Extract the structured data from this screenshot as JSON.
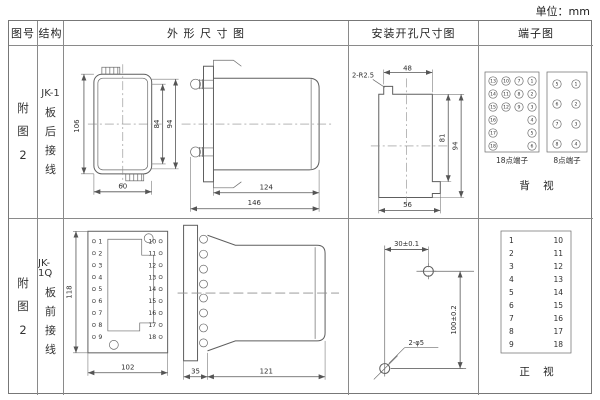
{
  "page": {
    "unit": "单位：mm"
  },
  "header": {
    "fig_no": "图号",
    "structure": "结构",
    "outline": "外 形 尺 寸 图",
    "mounting": "安装开孔尺寸图",
    "terminal": "端子图"
  },
  "row1": {
    "fig_no": [
      "附",
      "图",
      "2"
    ],
    "structure": [
      "JK-1",
      "板",
      "后",
      "接",
      "线"
    ],
    "outline": {
      "front_h": "106",
      "front_inner_h": "84",
      "front_outer_h": "94",
      "front_w": "60",
      "side_body": "124",
      "side_total": "146"
    },
    "mounting": {
      "corner_note": "2-R2.5",
      "top_w": "48",
      "inner_h": "81",
      "full_h": "94",
      "bottom_w": "56"
    },
    "t18": {
      "caption": "18点端子",
      "grid": [
        [
          "13",
          "10",
          "7",
          "1"
        ],
        [
          "14",
          "11",
          "8",
          "2"
        ],
        [
          "15",
          "12",
          "9",
          "3"
        ],
        [
          "16",
          "4"
        ],
        [
          "17",
          "5"
        ],
        [
          "18",
          "6"
        ]
      ]
    },
    "t8": {
      "caption": "8点端子",
      "left": [
        "5",
        "6",
        "7",
        "8"
      ],
      "right": [
        "1",
        "2",
        "3",
        "4"
      ]
    },
    "view_label": "背 视"
  },
  "row2": {
    "fig_no": [
      "附",
      "图",
      "2"
    ],
    "structure": [
      "JK-1Q",
      "板",
      "前",
      "接",
      "线"
    ],
    "outline": {
      "front_h": "118",
      "front_w": "102",
      "side_flange": "35",
      "side_body": "121"
    },
    "term_left": [
      "1",
      "2",
      "3",
      "4",
      "5",
      "6",
      "7",
      "8",
      "9"
    ],
    "term_right": [
      "10",
      "11",
      "12",
      "13",
      "14",
      "15",
      "16",
      "17",
      "18"
    ],
    "mounting": {
      "top_w": "30±0.1",
      "v_dist": "100±0.2",
      "holes_note": "2-φ5"
    },
    "view_label": "正 视"
  }
}
